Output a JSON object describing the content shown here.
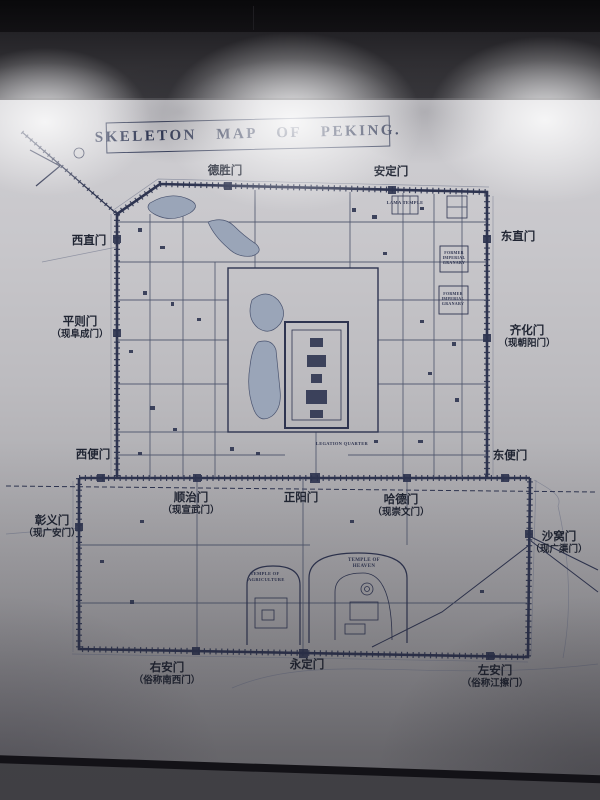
{
  "colors": {
    "ink": "#2e3450",
    "label_text": "#1f2432",
    "wall_light": "#d0cfd3",
    "wall_dark": "#8a898d",
    "floor": "#45444a"
  },
  "map": {
    "title": "SKELETON MAP OF PEKING.",
    "gates": [
      {
        "label": "德胜门",
        "sub": ""
      },
      {
        "label": "安定门",
        "sub": ""
      },
      {
        "label": "西直门",
        "sub": ""
      },
      {
        "label": "东直门",
        "sub": ""
      },
      {
        "label": "平则门",
        "sub": "（现阜成门）"
      },
      {
        "label": "齐化门",
        "sub": "（现朝阳门）"
      },
      {
        "label": "西便门",
        "sub": ""
      },
      {
        "label": "东便门",
        "sub": ""
      },
      {
        "label": "顺治门",
        "sub": "（现宣武门）"
      },
      {
        "label": "正阳门",
        "sub": ""
      },
      {
        "label": "哈德门",
        "sub": "（现崇文门）"
      },
      {
        "label": "彰义门",
        "sub": "（现广安门）"
      },
      {
        "label": "沙窝门",
        "sub": "（现广渠门）"
      },
      {
        "label": "右安门",
        "sub": "（俗称南西门）"
      },
      {
        "label": "永定门",
        "sub": ""
      },
      {
        "label": "左安门",
        "sub": "（俗称江擦门）"
      }
    ],
    "sites": {
      "lama_temple": "LAMA TEMPLE",
      "granary1": "FORMER IMPERIAL GRANARY",
      "granary2": "FORMER IMPERIAL GRANARY",
      "legation": "LEGATION QUARTER",
      "temple_heaven": "TEMPLE OF HEAVEN",
      "temple_agriculture": "TEMPLE OF AGRICULTURE"
    }
  }
}
